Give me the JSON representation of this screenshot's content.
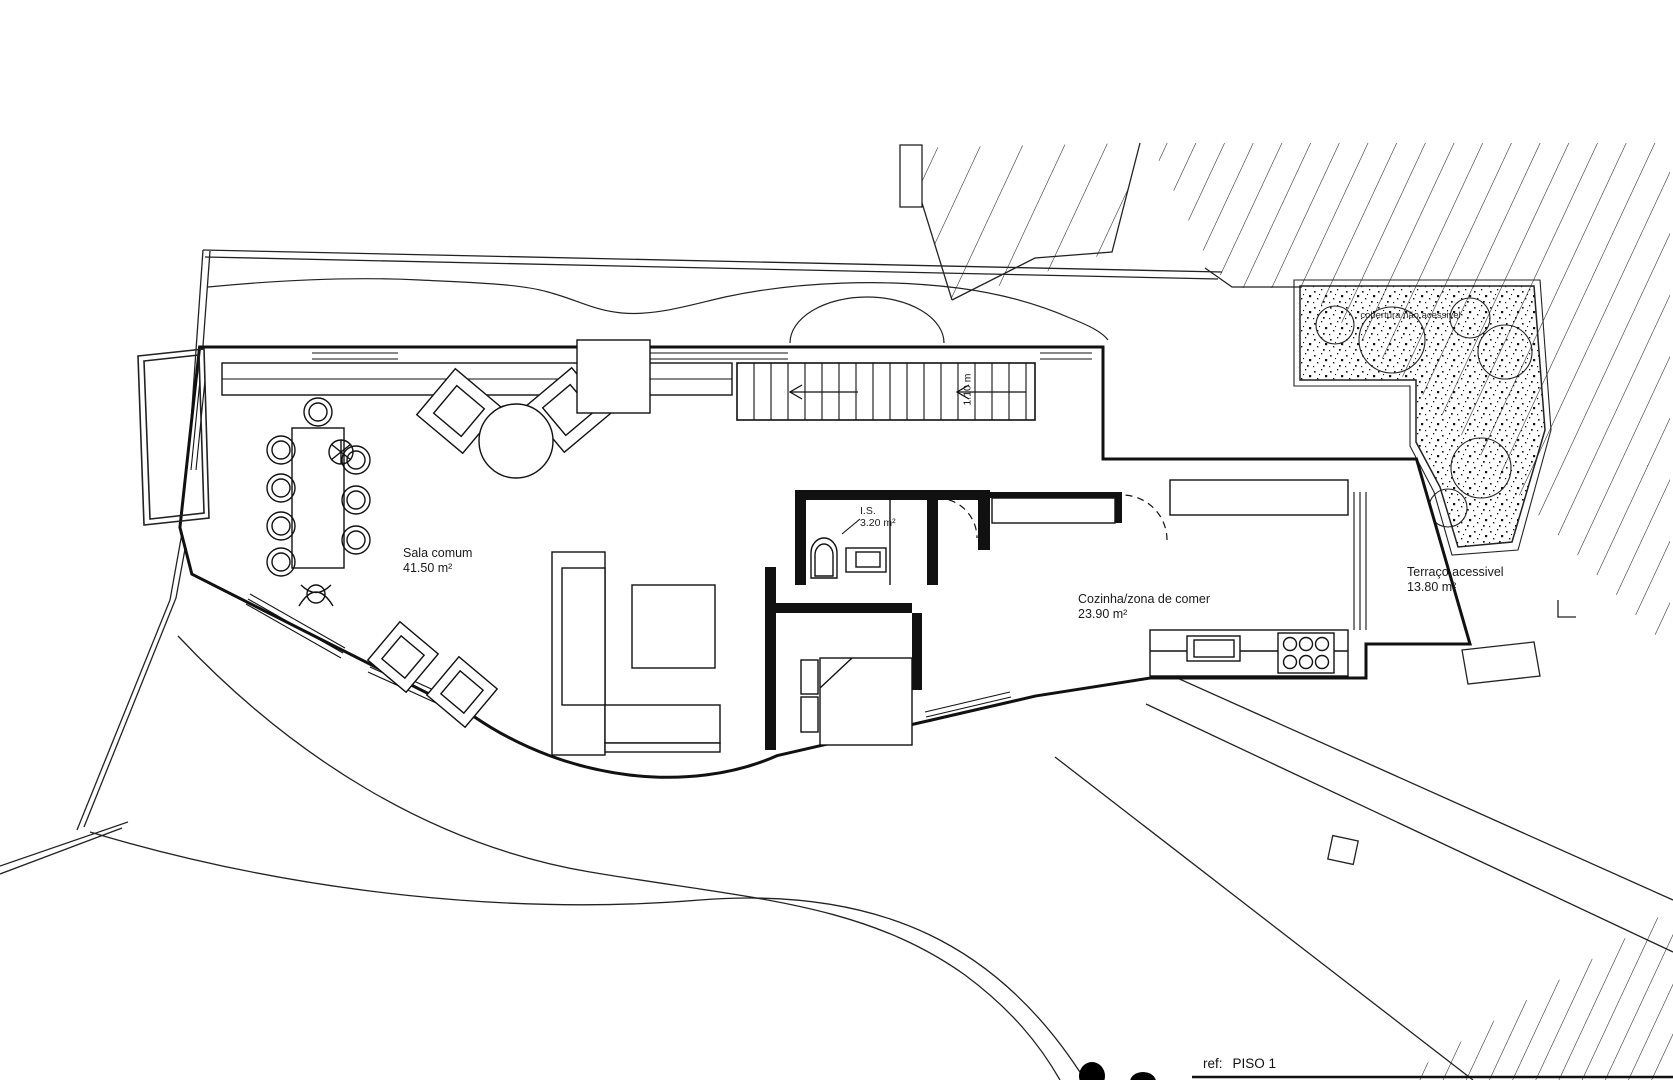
{
  "watermark": {
    "brand_main": "PREDIVILL",
    "brand_accent": "A",
    "tagline": "Mediação Imobiliária",
    "brand_color": "#7FA6C9",
    "accent_color": "#E7D2A0"
  },
  "rooms": {
    "living": {
      "name": "Sala comum",
      "area": "41.50 m²"
    },
    "bath": {
      "name": "I.S.",
      "area": "3.20 m²"
    },
    "kitchen": {
      "name": "Cozinha/zona de comer",
      "area": "23.90 m²"
    },
    "terrace": {
      "name": "Terraço acessivel",
      "area": "13.80 m²"
    },
    "roof": {
      "name": "cobertura não acessivel"
    }
  },
  "dimensions": {
    "stair_width": "1.10 m"
  },
  "titleblock": {
    "ref_label": "ref:",
    "ref_value": "PISO 1"
  }
}
